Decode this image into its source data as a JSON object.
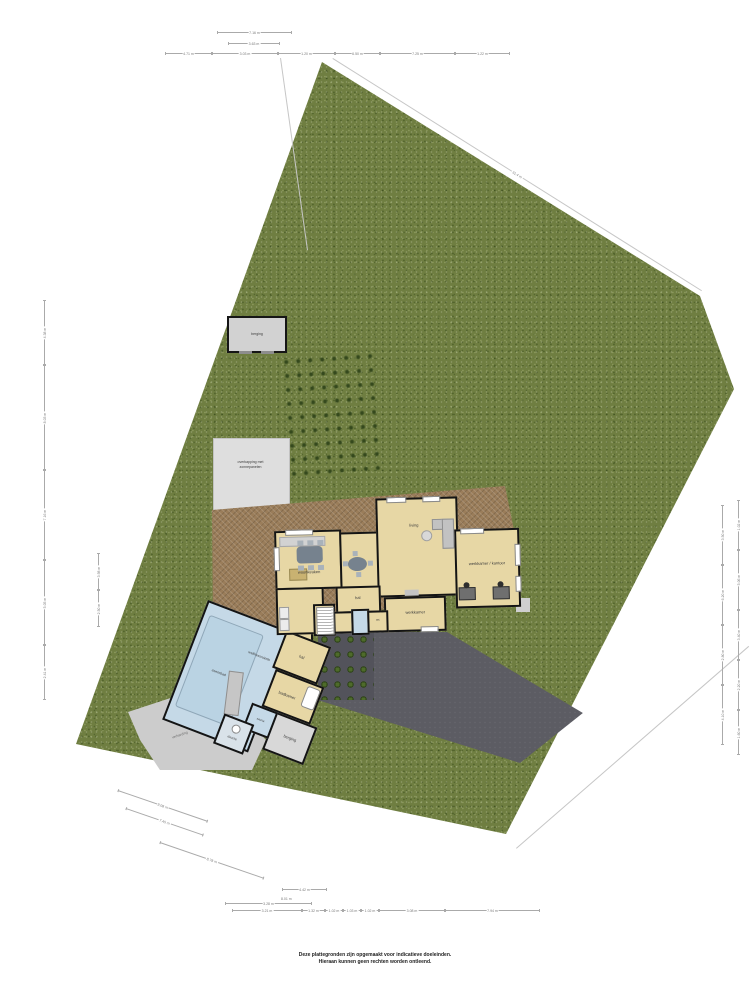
{
  "disclaimer": {
    "line1": "Deze plattegronden zijn opgemaakt voor indicatieve doeleinden.",
    "line2": "Hieraan kunnen geen rechten worden ontleend."
  },
  "site": {
    "boundary_top_length": "31.4 m"
  },
  "outbuildings": {
    "shed": "berging",
    "carport_line1": "overkapping met",
    "carport_line2": "zonnepanelen",
    "paving": "verharding"
  },
  "rooms": {
    "living": "living",
    "woonkeuken": "woonkeuken",
    "hal": "hal",
    "werkkamer": "werkkamer",
    "kantoor": "werkkamer / kantoor",
    "wc": "wc",
    "wellness": "wellnessruimte",
    "zwembad": "zwembad",
    "sauna": "sauna",
    "douche": "douche",
    "hal2": "hal",
    "badkamer": "badkamer",
    "berging": "berging"
  },
  "dimensions": {
    "top_row1": "7.16 m",
    "top_row2": "3.63 m",
    "top_row3": [
      "4.71 m",
      "3.03 m",
      "1.20 m",
      "6.50 m",
      "7.25 m",
      "1.22 m"
    ],
    "bottom_rowA": "4.42 m",
    "bottom_rowA2": "8.01 m",
    "bottom_rowB": "3.28 m",
    "bottom_rowC": [
      "3.21 m",
      "1.32 m",
      "1.02 m",
      "1.03 m",
      "1.02 m",
      "3.08 m",
      "7.94 m"
    ],
    "left_outer": [
      "4.38 m",
      "8.03 m",
      "7.16 m",
      "5.05 m",
      "2.41 m"
    ],
    "left_inner": [
      "3.98 m",
      "2.50 m"
    ],
    "right_inner": [
      "3.50 m",
      "6.20 m",
      "2.80 m",
      "4.10 m"
    ],
    "right_outer": [
      "1.02 m",
      "5.06 m",
      "3.40 m",
      "2.20 m",
      "1.60 m"
    ],
    "diagonal": [
      "9.08 m",
      "7.45 m",
      "8.78 m"
    ]
  }
}
